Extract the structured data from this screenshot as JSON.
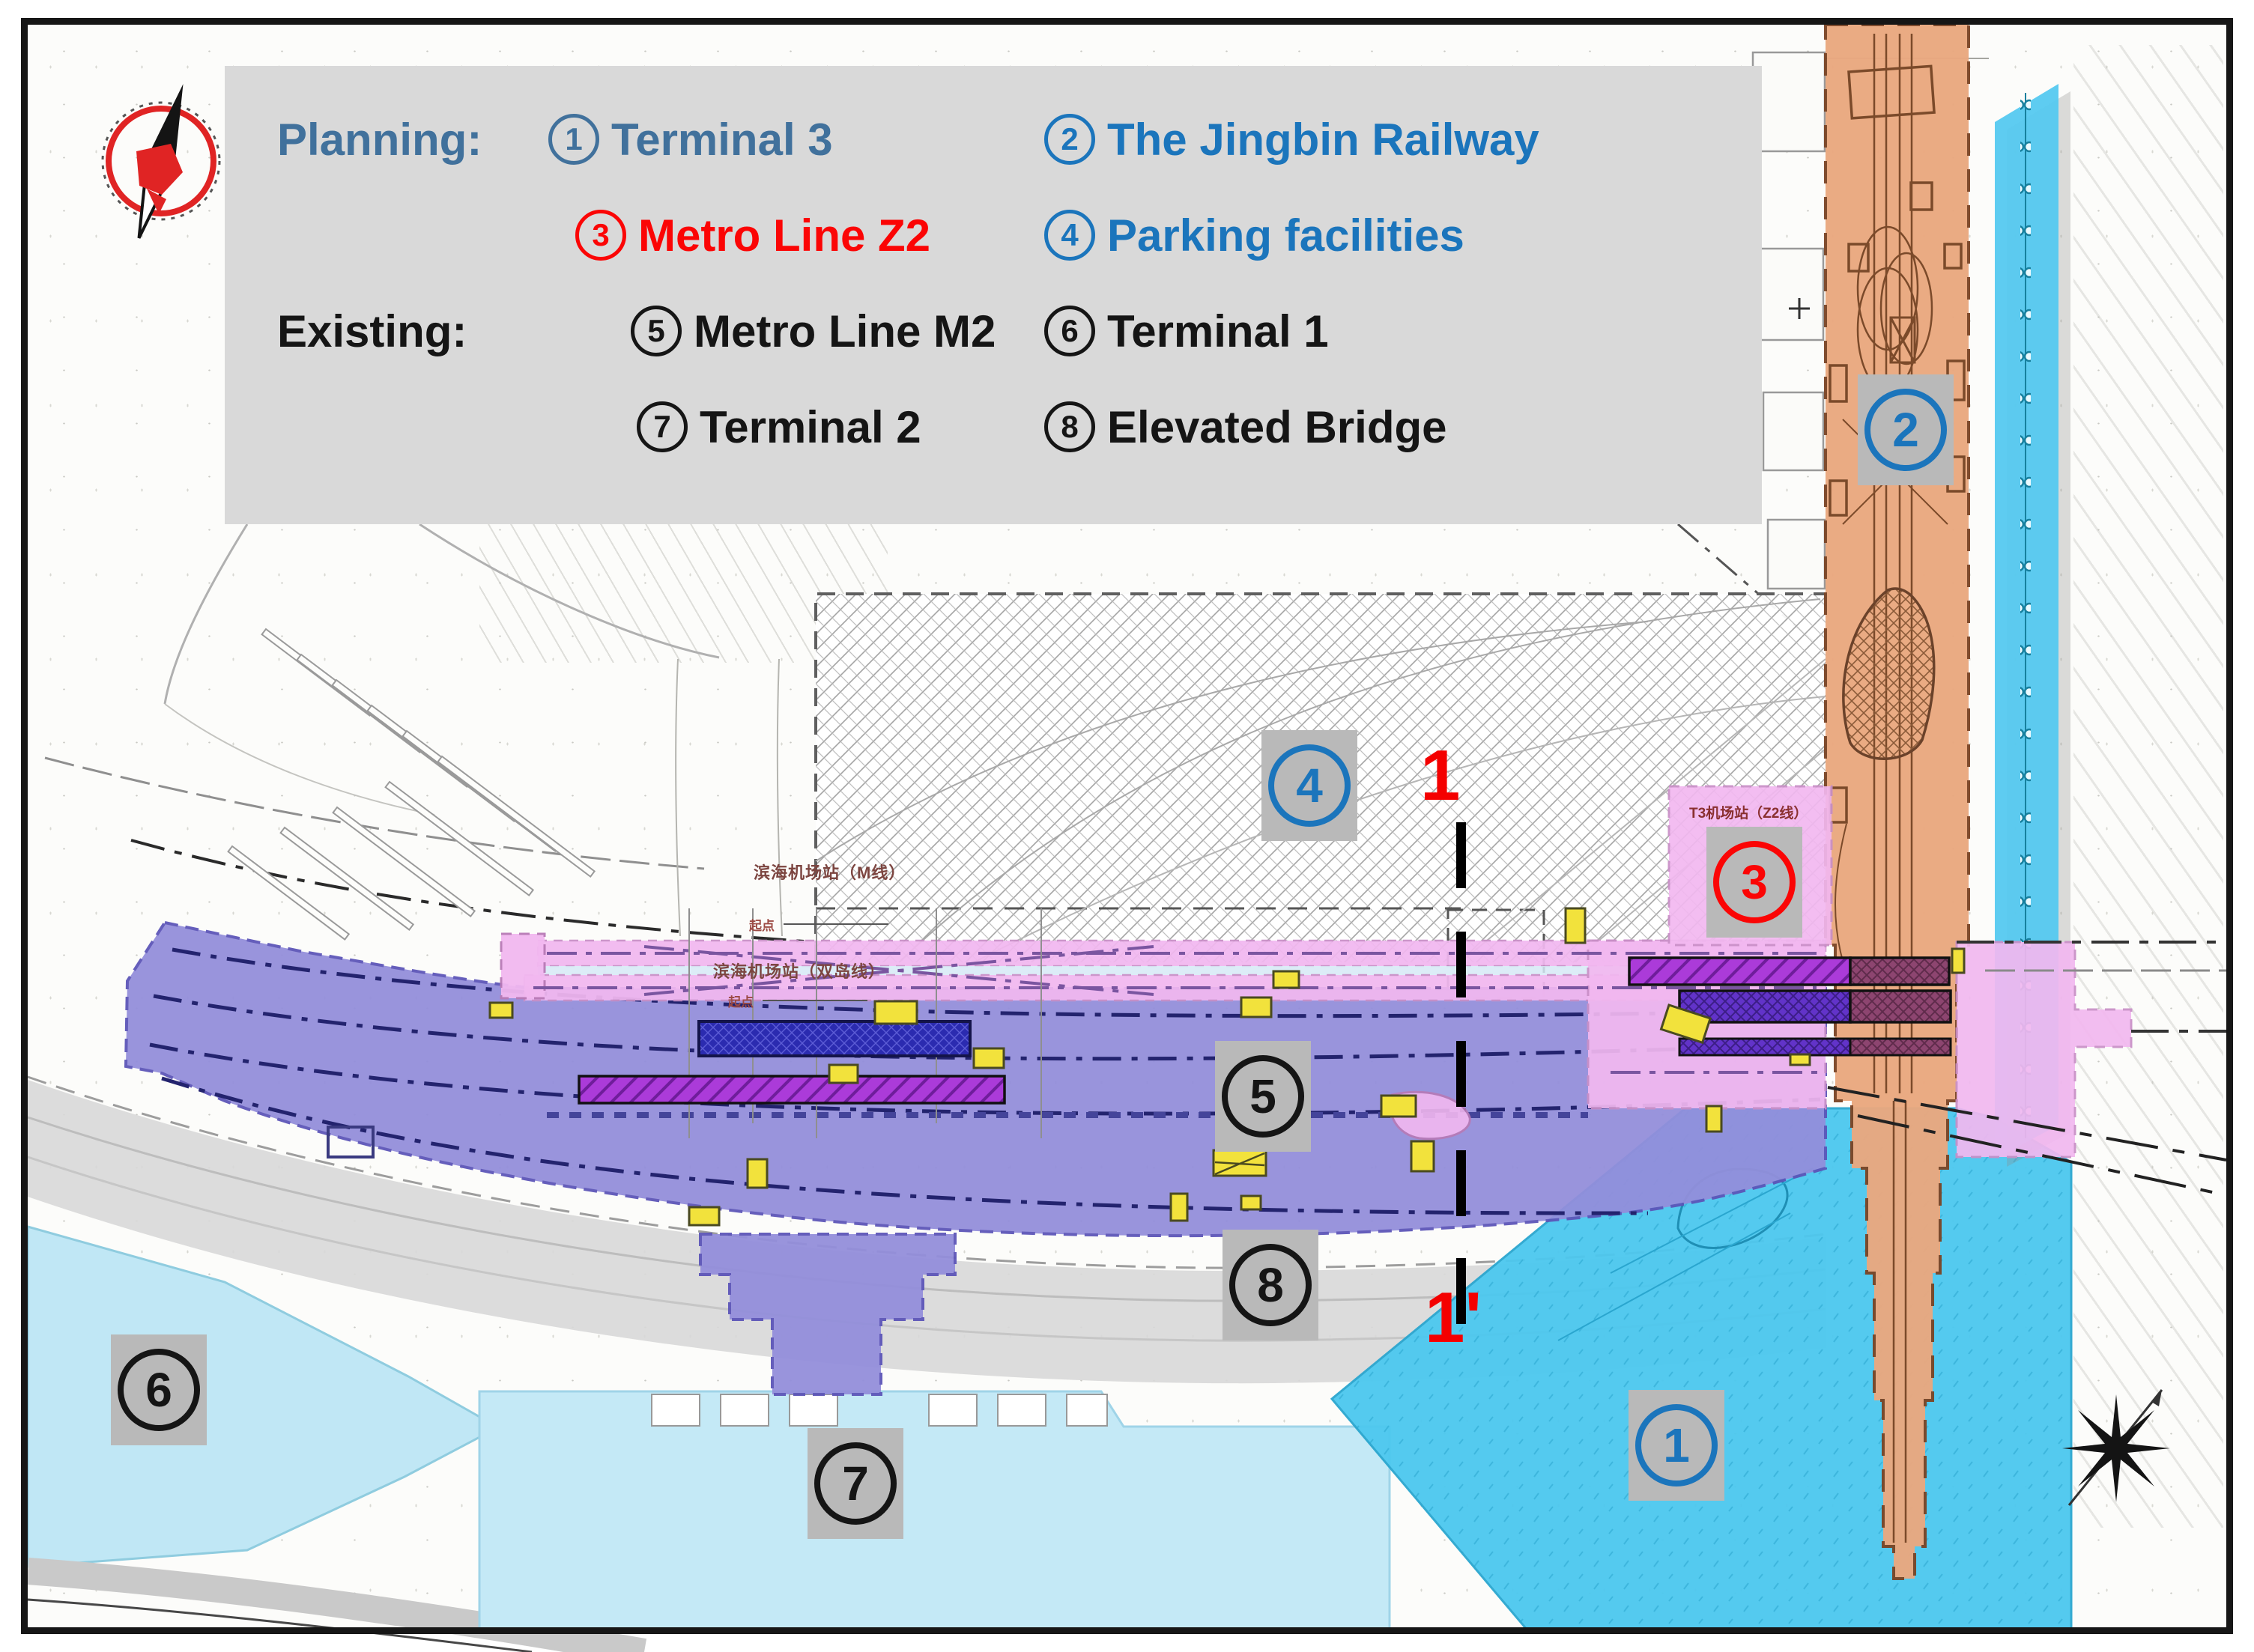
{
  "legend": {
    "planning_label": "Planning:",
    "existing_label": "Existing:",
    "items": [
      {
        "num": "1",
        "label": "Terminal 3"
      },
      {
        "num": "2",
        "label": "The Jingbin Railway"
      },
      {
        "num": "3",
        "label": "Metro Line Z2"
      },
      {
        "num": "4",
        "label": "Parking facilities"
      },
      {
        "num": "5",
        "label": "Metro Line M2"
      },
      {
        "num": "6",
        "label": "Terminal 1"
      },
      {
        "num": "7",
        "label": "Terminal 2"
      },
      {
        "num": "8",
        "label": "Elevated Bridge"
      }
    ]
  },
  "map_labels": [
    {
      "num": "1",
      "name": "Terminal 3"
    },
    {
      "num": "2",
      "name": "The Jingbin Railway"
    },
    {
      "num": "3",
      "name": "Metro Line Z2"
    },
    {
      "num": "4",
      "name": "Parking facilities"
    },
    {
      "num": "5",
      "name": "Metro Line M2"
    },
    {
      "num": "6",
      "name": "Terminal 1"
    },
    {
      "num": "7",
      "name": "Terminal 2"
    },
    {
      "num": "8",
      "name": "Elevated Bridge"
    }
  ],
  "section_line": {
    "start": "1",
    "end": "1'"
  },
  "annotations": {
    "station_m_line": "滨海机场站（M线）",
    "origin": "起点",
    "station_double_line": "滨海机场站（双岛线）",
    "t3_station": "T3机场站（Z2线）"
  },
  "colors": {
    "planning_heading_blue": "#41719c",
    "planning_item_blue": "#1b75bc",
    "metro_z2_red": "#fb0505",
    "existing_black": "#151515",
    "legend_panel_gray": "#d9d9d9",
    "label_box_gray": "#b9b9b9",
    "metro_m2_purple": "#938edb",
    "metro_z2_pink": "#f2b8f0",
    "jingbin_railway_orange": "#eaa87f",
    "terminal3_cyan": "#4cc8ef",
    "terminal_pale_cyan": "#c4e9f6",
    "elevated_bridge_gray": "#d8d8d8"
  }
}
